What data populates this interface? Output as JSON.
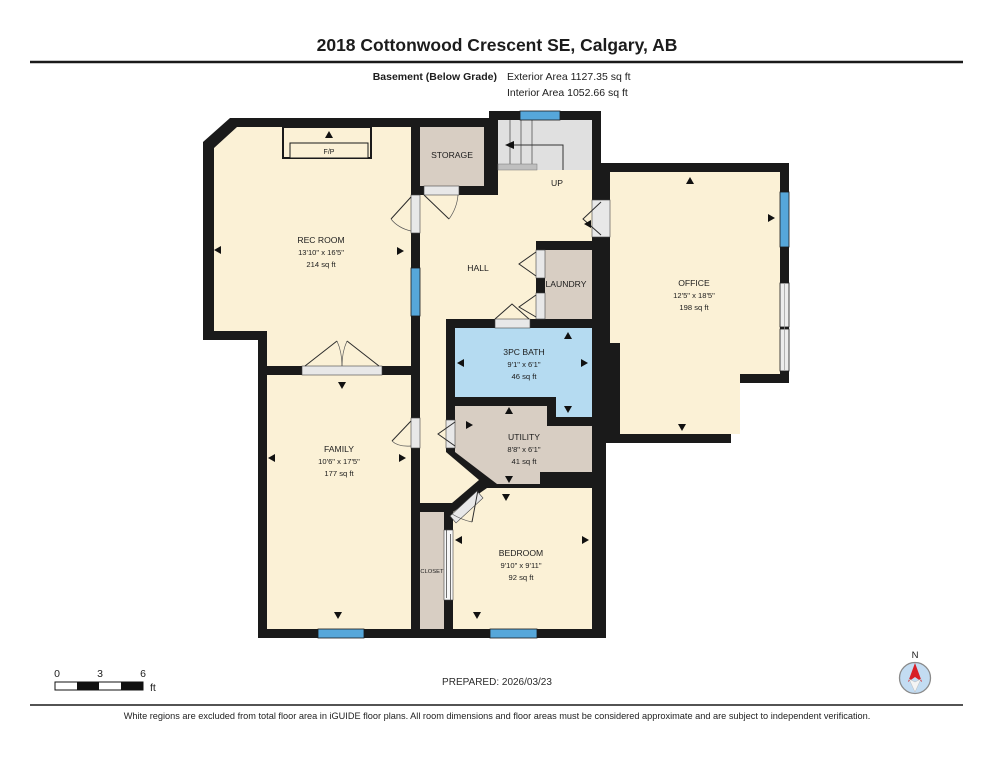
{
  "page": {
    "title": "2018 Cottonwood Crescent SE, Calgary, AB",
    "floor_label": "Basement (Below Grade)",
    "exterior_area": "Exterior Area 1127.35 sq ft",
    "interior_area": "Interior Area 1052.66 sq ft",
    "prepared": "PREPARED: 2026/03/23",
    "disclaimer": "White regions are excluded from total floor area in iGUIDE floor plans. All room dimensions and floor areas must be considered approximate and are subject to independent verification.",
    "scale": {
      "ticks": [
        "0",
        "3",
        "6"
      ],
      "unit": "ft"
    },
    "compass": {
      "north_label": "N"
    }
  },
  "rooms": {
    "rec": {
      "name": "REC ROOM",
      "dims": "13'10\" x 16'5\"",
      "area": "214 sq ft"
    },
    "storage": {
      "name": "STORAGE"
    },
    "stairs": {
      "direction": "UP"
    },
    "hall": {
      "name": "HALL"
    },
    "laundry": {
      "name": "LAUNDRY"
    },
    "office": {
      "name": "OFFICE",
      "dims": "12'5\" x 18'5\"",
      "area": "198 sq ft"
    },
    "bath": {
      "name": "3PC BATH",
      "dims": "9'1\" x 6'1\"",
      "area": "46 sq ft"
    },
    "utility": {
      "name": "UTILITY",
      "dims": "8'8\" x 6'1\"",
      "area": "41 sq ft"
    },
    "family": {
      "name": "FAMILY",
      "dims": "10'6\" x 17'5\"",
      "area": "177 sq ft"
    },
    "bedroom": {
      "name": "BEDROOM",
      "dims": "9'10\" x 9'11\"",
      "area": "92 sq ft"
    },
    "closet": {
      "name": "CLOSET"
    },
    "fireplace": {
      "name": "F/P"
    }
  },
  "colors": {
    "room_cream": "#FBF1D6",
    "room_tan": "#D8CEC3",
    "bath_blue": "#B5DBF1",
    "stairs_gray": "#E0E0E0",
    "landing_gray": "#BFBFBF",
    "window_blue": "#56A7DA",
    "wall_black": "#1a1a1a",
    "compass_fill": "#C3DCF2",
    "compass_north": "#D81F26"
  }
}
